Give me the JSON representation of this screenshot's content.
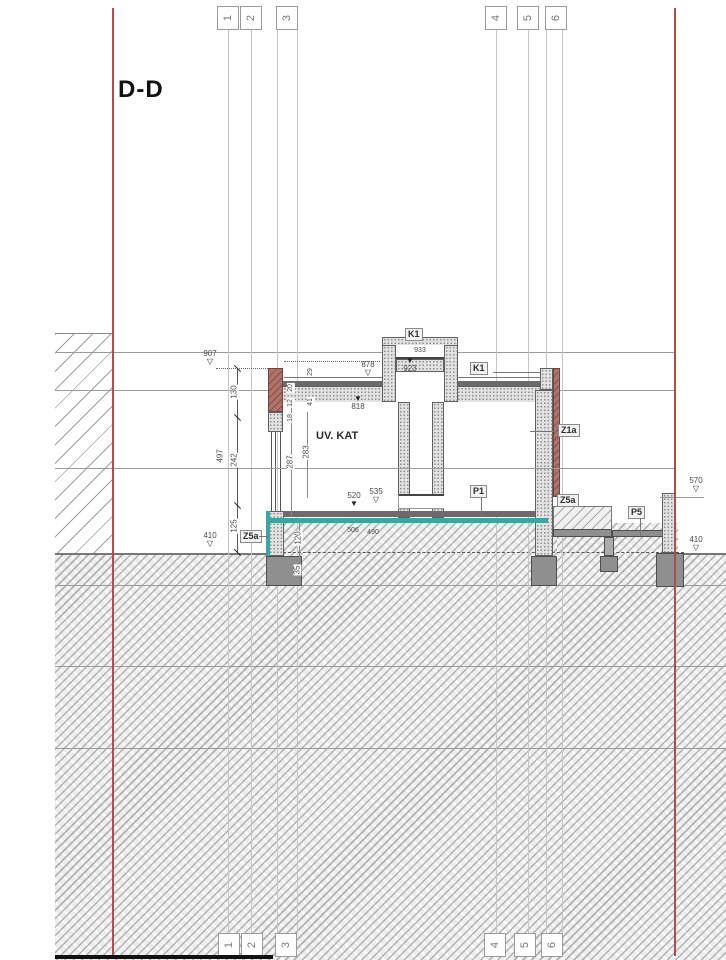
{
  "title": "D-D",
  "grid_bubbles": {
    "top": [
      "1",
      "2",
      "3",
      "4",
      "5",
      "6"
    ],
    "bottom": [
      "1",
      "2",
      "3",
      "4",
      "5",
      "6"
    ]
  },
  "room_label": "UV. KAT",
  "component_labels": {
    "skylight": "K1",
    "roof": "K1",
    "wall_right": "Z1a",
    "floor_interior": "P1",
    "slab_left": "Z5a",
    "slab_right": "Z5a",
    "terrace": "P5"
  },
  "level_markers": {
    "left_upper": "907",
    "left_lower": "410",
    "right_upper": "570",
    "right_lower": "410"
  },
  "spot_elevations": {
    "parapet_left": "878",
    "roof_slab_left": "818",
    "skylight_top": "933",
    "skylight_slab": "923",
    "floor_finish": "535",
    "floor_slab": "520",
    "under_slab_a": "506",
    "under_slab_b": "490"
  },
  "dimensions": {
    "overall": "497",
    "seg_upper": "130",
    "seg_mid": "242",
    "seg_lower": "125",
    "interior_a": "287",
    "interior_b": "283",
    "plinth": "120",
    "footing": "35",
    "details": [
      "29",
      "41",
      "20",
      "12",
      "18"
    ]
  },
  "colors": {
    "boundary_red": "#b34d4d",
    "waterproof_teal": "#3aa69f",
    "facade_brick": "#b0736b"
  }
}
